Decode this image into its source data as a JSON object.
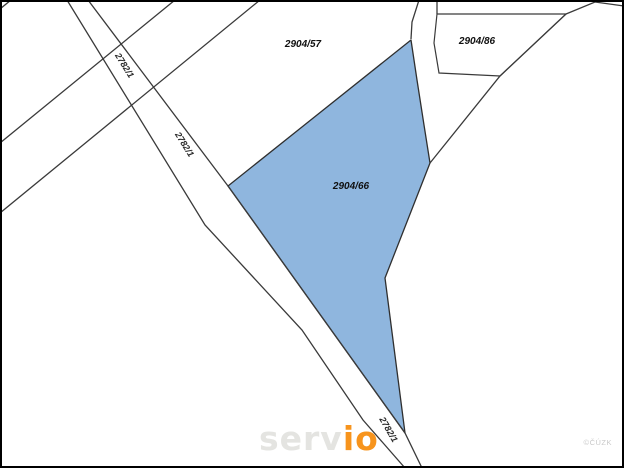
{
  "map": {
    "colors": {
      "background": "#ffffff",
      "frame": "#000000",
      "line": "#3a3a3a",
      "parcel_fill": "#ffffff",
      "highlight_fill": "#8fb6de",
      "highlight_stroke": "#2f2f2f",
      "label": "#101010"
    },
    "geometry": {
      "frame": {
        "x": 1,
        "y": 1,
        "width": 622,
        "height": 466,
        "stroke_width": 2
      },
      "lines": [
        {
          "name": "road-left-edge",
          "points": [
            [
              67,
              0
            ],
            [
              205,
              225
            ],
            [
              302,
              330
            ],
            [
              363,
              420
            ],
            [
              405,
              468
            ]
          ]
        },
        {
          "name": "road-right-edge",
          "points": [
            [
              88,
              0
            ],
            [
              228,
              186
            ],
            [
              405,
              433
            ],
            [
              422,
              468
            ]
          ]
        },
        {
          "name": "cross-road-upper",
          "points": [
            [
              0,
              143
            ],
            [
              175,
              0
            ]
          ]
        },
        {
          "name": "cross-road-lower",
          "points": [
            [
              0,
              213
            ],
            [
              260,
              0
            ]
          ]
        },
        {
          "name": "corner-tick",
          "points": [
            [
              0,
              9
            ],
            [
              11,
              0
            ]
          ]
        },
        {
          "name": "se-boundary",
          "points": [
            [
              566,
              14
            ],
            [
              500,
              76
            ],
            [
              430,
              163
            ]
          ]
        },
        {
          "name": "strip-left-edge",
          "points": [
            [
              419,
              0
            ],
            [
              412,
              22
            ],
            [
              411,
              39
            ]
          ]
        },
        {
          "name": "strip-right-edge",
          "points": [
            [
              437,
              0
            ],
            [
              437,
              14
            ]
          ]
        },
        {
          "name": "ne-boundary",
          "points": [
            [
              566,
              14
            ],
            [
              595,
              2
            ],
            [
              624,
              6
            ]
          ]
        }
      ],
      "parcels": [
        {
          "name": "parcel-2904-86",
          "points": [
            [
              437,
              14
            ],
            [
              566,
              14
            ],
            [
              500,
              76
            ],
            [
              439,
              73
            ],
            [
              434,
              43
            ]
          ]
        }
      ],
      "highlight_parcel": {
        "name": "parcel-2904-66",
        "points": [
          [
            228,
            186
          ],
          [
            411,
            40
          ],
          [
            417,
            80
          ],
          [
            424,
            125
          ],
          [
            430,
            163
          ],
          [
            385,
            278
          ],
          [
            405,
            433
          ]
        ]
      }
    },
    "labels": [
      {
        "text": "2904/57",
        "x": 303,
        "y": 47,
        "rotate": 0,
        "kind": "parcel-label"
      },
      {
        "text": "2904/86",
        "x": 477,
        "y": 44,
        "rotate": 0,
        "kind": "parcel-label"
      },
      {
        "text": "2904/66",
        "x": 351,
        "y": 189,
        "rotate": 0,
        "kind": "parcel-label"
      },
      {
        "text": "2782/1",
        "x": 122,
        "y": 67,
        "rotate": 58,
        "kind": "road-label"
      },
      {
        "text": "2782/1",
        "x": 182,
        "y": 146,
        "rotate": 58,
        "kind": "road-label"
      },
      {
        "text": "2782/1",
        "x": 386,
        "y": 431,
        "rotate": 60,
        "kind": "road-label"
      }
    ]
  },
  "logo": {
    "left": "serv",
    "right": "io",
    "left_color": "#e4e4e1",
    "right_color": "#f7941d"
  },
  "watermark": "©ČÚZK"
}
